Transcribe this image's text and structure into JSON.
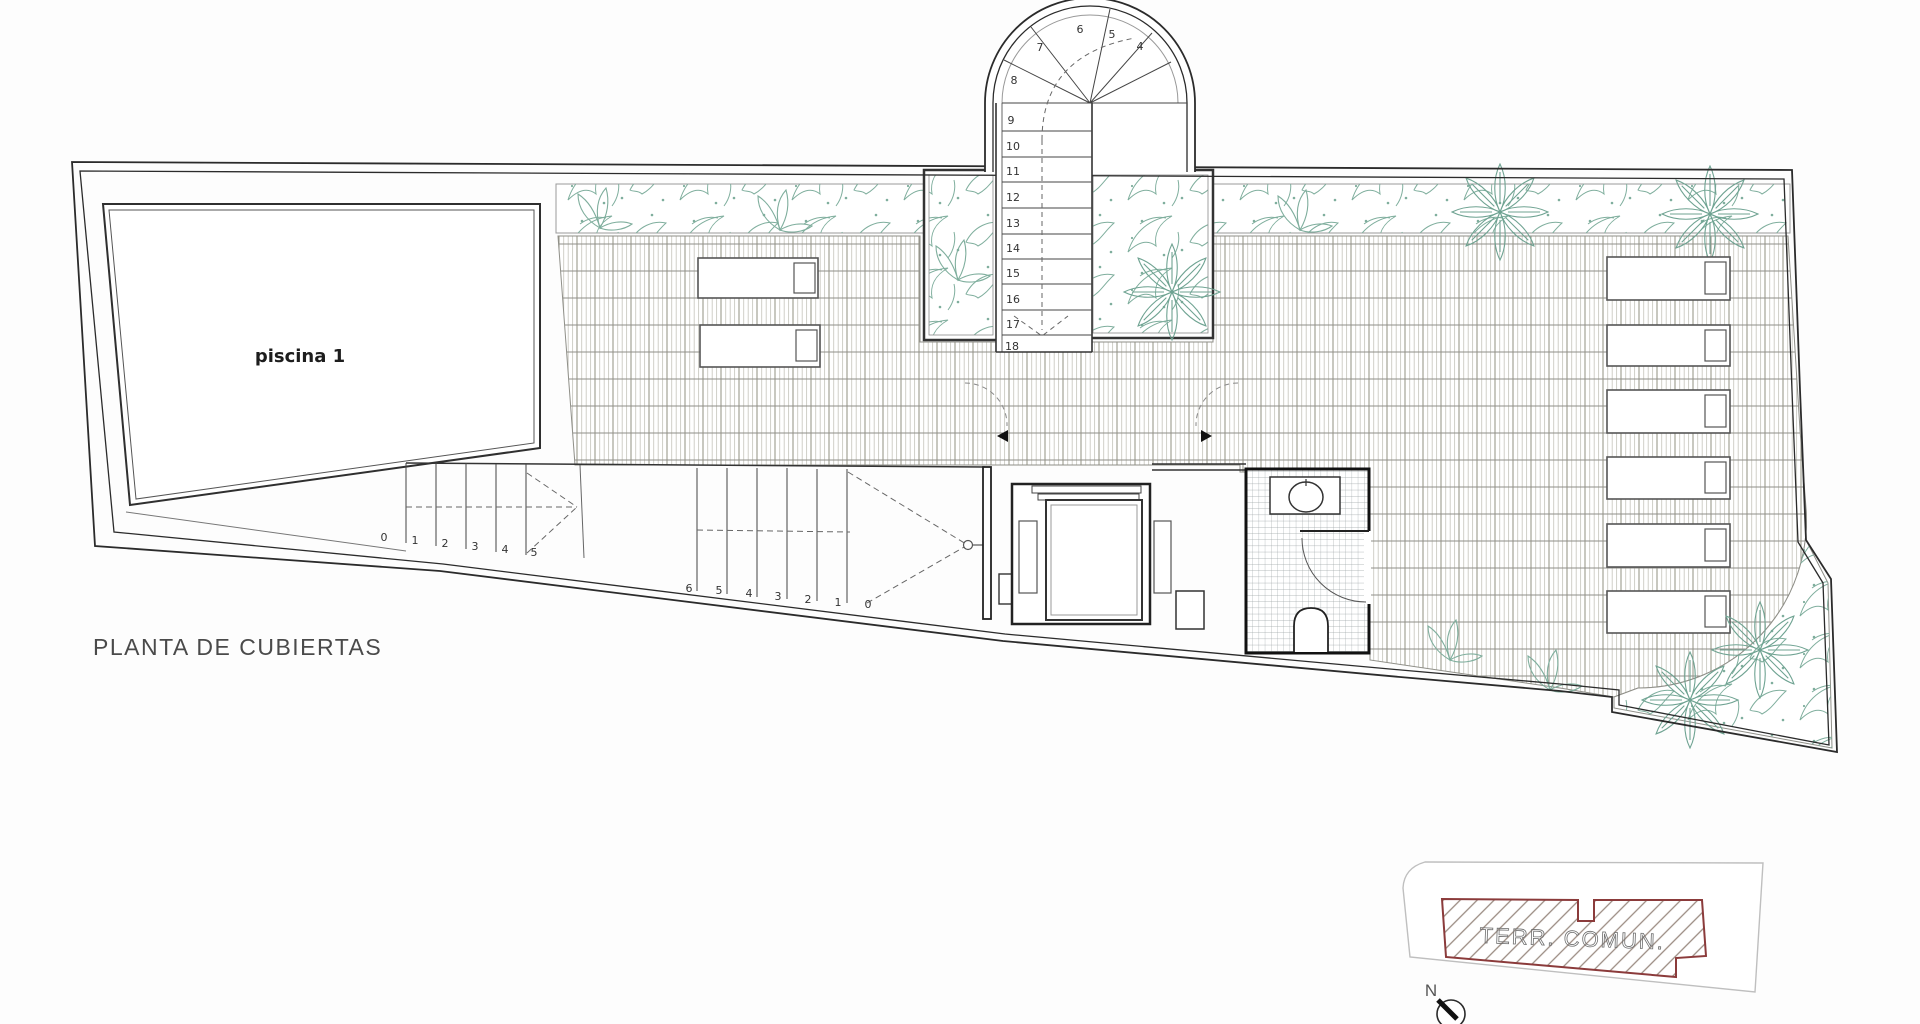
{
  "title": {
    "label": "PLANTA DE CUBIERTAS"
  },
  "plan": {
    "pool_label": "piscina 1",
    "stairs": {
      "flight_a": [
        "0",
        "1",
        "2",
        "3",
        "4",
        "5"
      ],
      "flight_b": [
        "6",
        "5",
        "4",
        "3",
        "2",
        "1",
        "0"
      ],
      "fan": [
        "4",
        "5",
        "6",
        "7",
        "8"
      ],
      "upper_flight": [
        "9",
        "10",
        "11",
        "12",
        "13",
        "14",
        "15",
        "16",
        "17",
        "18"
      ]
    }
  },
  "key_plan": {
    "area_label": "TERR. COMUN.",
    "north_label": "N"
  },
  "colors": {
    "wall": "#2b2b2b",
    "tile_line_dark": "#9b9a8e",
    "tile_line_light": "#cbcac2",
    "tile_row_line": "#8f8f88",
    "plant_green": "#7fae9d",
    "keyplan_red": "#8b3b3b",
    "keyplan_hatch": "#9a8b82",
    "keyplan_outline": "#bfbfbf"
  }
}
